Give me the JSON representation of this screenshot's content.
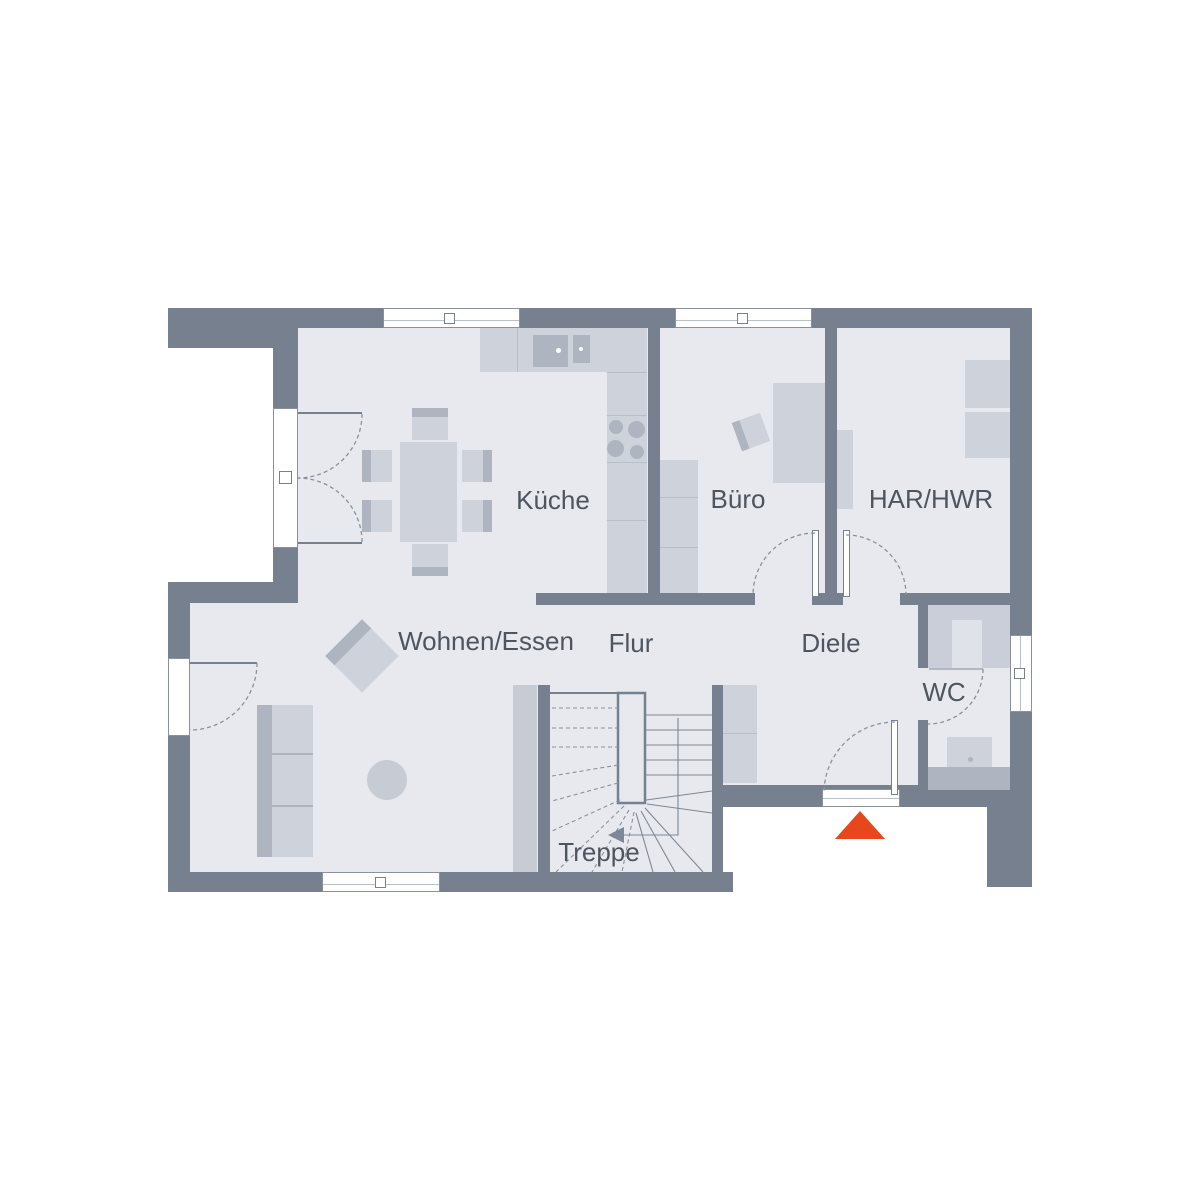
{
  "rooms": {
    "kueche": {
      "label": "Küche"
    },
    "buero": {
      "label": "Büro"
    },
    "har_hwr": {
      "label": "HAR/HWR"
    },
    "wohnen_essen": {
      "label": "Wohnen/Essen"
    },
    "flur": {
      "label": "Flur"
    },
    "diele": {
      "label": "Diele"
    },
    "wc": {
      "label": "WC"
    },
    "treppe": {
      "label": "Treppe"
    }
  },
  "colors": {
    "wall": "#76808e",
    "floor": "#e7e9ee",
    "furniture": "#ced3db",
    "furniture_dark": "#aeb4c0",
    "furniture_mid": "#c6cbd4",
    "stroke": "#8a919d",
    "text": "#4e555f",
    "entrance_marker": "#e8461c"
  },
  "icons": {
    "entrance_marker": "triangle-up"
  }
}
